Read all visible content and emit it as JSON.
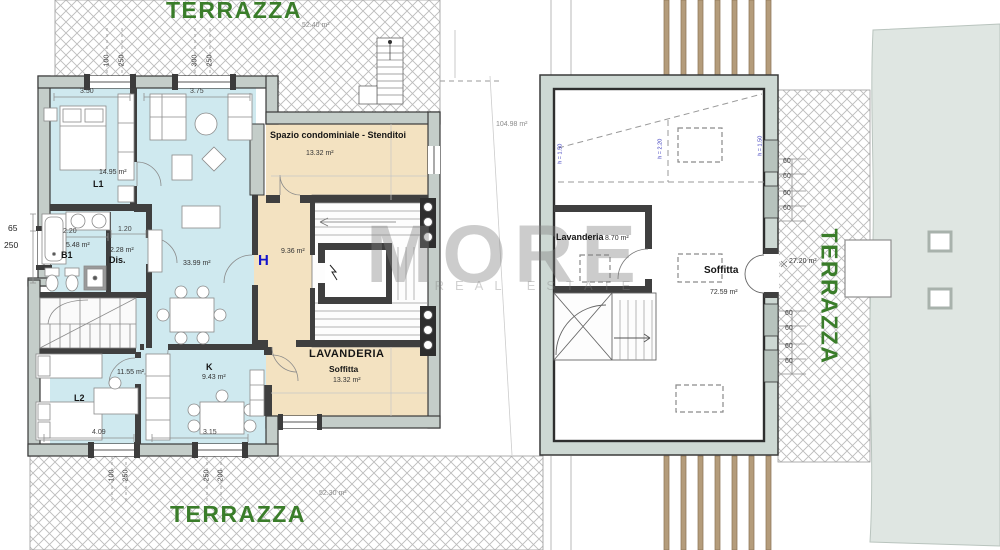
{
  "watermark": {
    "brand": "MORE",
    "tagline": "REAL ESTATE"
  },
  "colors": {
    "terrace_text_green": "#3a7d2a",
    "floor_blue": "#cfe9ef",
    "floor_beige": "#f3e2c1",
    "wall_fill": "#c4cdc9",
    "beam_wood": "#b49c7b",
    "elevator_symbol_blue": "#1414cc",
    "height_note_blue": "#3434bb"
  },
  "left_plan": {
    "terrace_top": {
      "name": "TERRAZZA",
      "area": "52.40 m²"
    },
    "terrace_bottom": {
      "name": "TERRAZZA",
      "area": "52.30 m²"
    },
    "rooms": {
      "l1": {
        "name": "L1",
        "area": "14.95 m²",
        "width": "3.50"
      },
      "living": {
        "area": "33.99 m²",
        "width": "3.75"
      },
      "b1": {
        "name": "B1",
        "area": "5.48 m²",
        "width": "2.20"
      },
      "dis": {
        "name": "Dis.",
        "area": "2.28 m²",
        "width": "1.20"
      },
      "hall": {
        "symbol": "H",
        "area": "9.36 m²"
      },
      "spazio": {
        "name": "Spazio condominiale - Stenditoi",
        "area": "13.32 m²"
      },
      "lavanderia": {
        "name": "LAVANDERIA",
        "subname": "Soffitta",
        "area": "13.32 m²"
      },
      "l2": {
        "name": "L2",
        "area": "11.55 m²",
        "width": "4.09"
      },
      "k": {
        "name": "K",
        "area": "9.43 m²",
        "width": "3.15"
      }
    },
    "dims": {
      "top": [
        "100",
        "250",
        "300",
        "250"
      ],
      "bottom": [
        "100",
        "250",
        "250",
        "200"
      ],
      "left": [
        "65",
        "250"
      ]
    }
  },
  "right_plan": {
    "total": "104.98 m²",
    "rooms": {
      "lavanderia": {
        "name": "Lavanderia",
        "area": "8.70 m²"
      },
      "soffitta": {
        "name": "Soffitta",
        "area": "72.59 m²"
      }
    },
    "terrace": {
      "name": "TERRAZZA",
      "area": "27.20 m²"
    },
    "dims_60": [
      "60",
      "60",
      "60",
      "60",
      "60",
      "60",
      "60",
      "60"
    ],
    "heights": [
      "h = 1.50",
      "h = 2.20",
      "h = 1.50"
    ]
  }
}
